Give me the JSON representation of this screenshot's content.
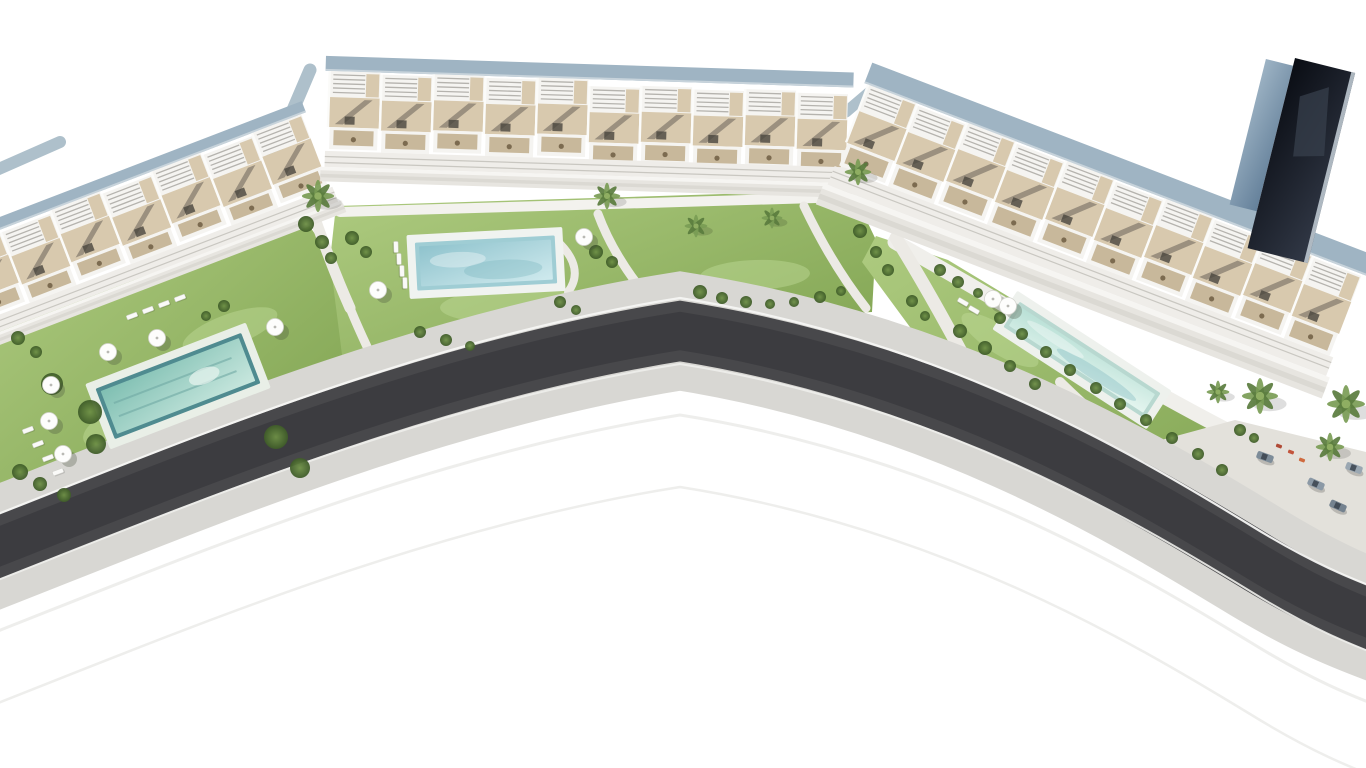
{
  "scene": {
    "width": 1366,
    "height": 768,
    "background": "#ffffff"
  },
  "palette": {
    "grass1": "#aecb80",
    "grass2": "#7ca04d",
    "grass_light": "#c2db9a",
    "bush_core": "#6e9046",
    "bush_edge": "#3f5c29",
    "palm1": "#5a7c3e",
    "palm2": "#7a9c55",
    "palm_crown": "#8fae62",
    "path": "#eceae5",
    "promenade": "#f3f2ee",
    "plaza": "#e3e1db",
    "sidewalk": "#d8d7d3",
    "asphalt": "#48484b",
    "asphalt_core": "#3a3a3d",
    "curb": "#f5f5f3",
    "curb_low": "#eeeeeb",
    "faint_arc": "#ececea",
    "white": "#f5f4f1",
    "beige": "#d8c9ae",
    "beige_dark": "#c3b191",
    "stripe": "#b5b3ae",
    "shadow": "#5e5850",
    "window": "#4a463f",
    "roof": "#9fb4c3",
    "roof_edge": "#c7d3db",
    "facade": "#efede9",
    "facade_line": "#c9c7c1",
    "walk1": "#f6f5f2",
    "walk2": "#e7e5e0",
    "walk3": "#dbd9d3",
    "wall": "#aec0cb",
    "umbrella": "#fdfdfc",
    "umbrella_rim": "#d5d5d0",
    "umbrella_shadow": "#44503a",
    "lounger": "#fafaf8",
    "lounger_rim": "#cfcfca",
    "furniture_dot": "#7c6b50",
    "tower_edge": "#c6d0d8",
    "tower_glint": "#39414f",
    "car_glass": "#39434d"
  },
  "road": {
    "centerline": "M -30 558 C 170 480, 420 372, 680 331 C 940 372, 1130 485, 1250 558 C 1310 595, 1350 612, 1400 630",
    "sidewalk_w": 118,
    "asphalt_w": 60,
    "core_w": 38,
    "curb_offset": 33,
    "faint_offsets": [
      84,
      156
    ]
  },
  "gardens": [
    {
      "name": "left-garden",
      "points": "0,318 300,212 334,262 352,398 232,470 62,506 0,516"
    },
    {
      "name": "middle-garden",
      "points": "336,206 852,190 876,240 872,312 700,322 430,380 348,402 330,260"
    },
    {
      "name": "right-garden",
      "points": "876,236 948,260 1140,376 1310,468 1348,522 1240,522 1060,440 918,338 862,262"
    }
  ],
  "grass_patches": [
    [
      140,
      420,
      60,
      22,
      -20
    ],
    [
      520,
      305,
      80,
      18,
      -2
    ],
    [
      755,
      275,
      55,
      15,
      -2
    ],
    [
      1000,
      340,
      45,
      14,
      33
    ],
    [
      230,
      330,
      50,
      16,
      -20
    ]
  ],
  "plaza": {
    "points": "1095,458 1235,420 1366,452 1366,572 1200,525"
  },
  "paths": [
    {
      "name": "left-promenade",
      "d": "M 0,322 L 300,216",
      "w": 10,
      "c": "#f3f2ee"
    },
    {
      "name": "middle-promenade",
      "d": "M 340,212 L 850,197",
      "w": 10,
      "c": "#f3f2ee"
    },
    {
      "name": "right-promenade",
      "d": "M 895,242 C 1030,318 1180,412 1312,472",
      "w": 15,
      "c": "#f0efeb"
    },
    {
      "name": "gap-path-left",
      "d": "M 308,198 C 322,240 334,272 350,308",
      "w": 11
    },
    {
      "name": "gap-path-left-lower",
      "d": "M 350,308 C 358,328 366,344 372,358",
      "w": 9
    },
    {
      "name": "middle-garden-path-1",
      "d": "M 598,214 C 612,252 636,286 664,316",
      "w": 9
    },
    {
      "name": "middle-garden-path-2",
      "d": "M 804,206 C 824,248 844,280 866,308",
      "w": 9
    },
    {
      "name": "gap-path-right",
      "d": "M 896,238 C 925,285 950,330 975,378",
      "w": 13
    },
    {
      "name": "pool-loop-path",
      "d": "M 556,240 C 576,258 580,276 568,292",
      "w": 8
    },
    {
      "name": "right-garden-path",
      "d": "M 1060,382 C 1090,412 1120,436 1150,458",
      "w": 10
    }
  ],
  "walls": [
    {
      "name": "rear-wall-left-gap",
      "d": "M 252,206 L 310,70",
      "w": 13
    },
    {
      "name": "rear-wall-far-left",
      "d": "M -8,172 L 60,142",
      "w": 12
    },
    {
      "name": "rear-wall-right-gap",
      "d": "M 846,112 L 886,78",
      "w": 11
    }
  ],
  "buildings": [
    {
      "name": "left-building",
      "x": -55,
      "y": 238,
      "angle": -21,
      "units": 7,
      "uw": 54,
      "alt": 3,
      "kink_at": 99,
      "kink_dy": 0,
      "roof_h": 12,
      "perg_h": 26,
      "terr_h": 30,
      "balc_h": 20,
      "fac_h": 16,
      "base_h": 12
    },
    {
      "name": "middle-building",
      "x": 330,
      "y": 56,
      "angle": 1.8,
      "units": 10,
      "uw": 52,
      "alt": 2,
      "kink_at": 5,
      "kink_dy": 5,
      "roof_h": 15,
      "perg_h": 26,
      "terr_h": 30,
      "balc_h": 22,
      "fac_h": 16,
      "base_h": 14
    },
    {
      "name": "right-building",
      "x": 876,
      "y": 64,
      "angle": 21,
      "units": 10,
      "uw": 53,
      "alt": 2,
      "kink_at": 99,
      "kink_dy": 0,
      "roof_h": 22,
      "perg_h": 28,
      "terr_h": 34,
      "balc_h": 24,
      "fac_h": 20,
      "base_h": 22
    }
  ],
  "tower": {
    "x": 1295,
    "y": 58,
    "angle": 14,
    "dark_w": 62,
    "dark_h": 196,
    "side_w": 28,
    "side_h": 150,
    "side_y": 8
  },
  "pools": [
    {
      "name": "left-pool",
      "x": 178,
      "y": 386,
      "angle": -21,
      "w": 156,
      "h": 54,
      "deck": "#e9efe7",
      "rim": "#4f8b90",
      "water": "waterA",
      "lanes": true
    },
    {
      "name": "middle-pool",
      "x": 486,
      "y": 263,
      "angle": -3,
      "w": 140,
      "h": 48,
      "deck": "#f0f3f0",
      "rim": "#9fcdd4",
      "water": "waterB",
      "lanes": false
    },
    {
      "name": "right-pool",
      "x": 1082,
      "y": 360,
      "angle": 33,
      "w": 168,
      "h": 30,
      "deck": "#eef1ed",
      "rim": "#b8d8d0",
      "water": "waterC",
      "lanes": false
    }
  ],
  "bushes": [
    [
      18,
      338,
      7
    ],
    [
      36,
      352,
      6
    ],
    [
      306,
      224,
      8
    ],
    [
      322,
      242,
      7
    ],
    [
      331,
      258,
      6
    ],
    [
      20,
      472,
      8
    ],
    [
      40,
      484,
      7
    ],
    [
      64,
      495,
      7
    ],
    [
      52,
      384,
      11
    ],
    [
      90,
      412,
      12
    ],
    [
      96,
      444,
      10
    ],
    [
      276,
      437,
      12
    ],
    [
      300,
      468,
      10
    ],
    [
      224,
      306,
      6
    ],
    [
      206,
      316,
      5
    ],
    [
      352,
      238,
      7
    ],
    [
      366,
      252,
      6
    ],
    [
      420,
      332,
      6
    ],
    [
      446,
      340,
      6
    ],
    [
      470,
      346,
      5
    ],
    [
      560,
      302,
      6
    ],
    [
      576,
      310,
      5
    ],
    [
      596,
      252,
      7
    ],
    [
      612,
      262,
      6
    ],
    [
      700,
      292,
      7
    ],
    [
      722,
      298,
      6
    ],
    [
      746,
      302,
      6
    ],
    [
      770,
      304,
      5
    ],
    [
      794,
      302,
      5
    ],
    [
      820,
      297,
      6
    ],
    [
      841,
      291,
      5
    ],
    [
      860,
      231,
      7
    ],
    [
      876,
      252,
      6
    ],
    [
      888,
      270,
      6
    ],
    [
      940,
      270,
      6
    ],
    [
      958,
      282,
      6
    ],
    [
      978,
      293,
      5
    ],
    [
      1000,
      318,
      6
    ],
    [
      1022,
      334,
      6
    ],
    [
      1046,
      352,
      6
    ],
    [
      1070,
      370,
      6
    ],
    [
      1096,
      388,
      6
    ],
    [
      1120,
      404,
      6
    ],
    [
      1146,
      420,
      6
    ],
    [
      1172,
      438,
      6
    ],
    [
      1198,
      454,
      6
    ],
    [
      960,
      331,
      7
    ],
    [
      985,
      348,
      7
    ],
    [
      1010,
      366,
      6
    ],
    [
      1035,
      384,
      6
    ],
    [
      912,
      301,
      6
    ],
    [
      925,
      316,
      5
    ],
    [
      1240,
      430,
      6
    ],
    [
      1254,
      438,
      5
    ],
    [
      1222,
      470,
      6
    ]
  ],
  "palms": [
    [
      318,
      196,
      17
    ],
    [
      607,
      196,
      14
    ],
    [
      696,
      226,
      12
    ],
    [
      772,
      218,
      11
    ],
    [
      858,
      172,
      14
    ],
    [
      1218,
      392,
      12
    ],
    [
      1260,
      396,
      19
    ],
    [
      1346,
      404,
      20
    ],
    [
      1330,
      447,
      15
    ]
  ],
  "umbrellas": [
    [
      275,
      327
    ],
    [
      157,
      338
    ],
    [
      108,
      352
    ],
    [
      51,
      385
    ],
    [
      49,
      421
    ],
    [
      63,
      454
    ],
    [
      378,
      290
    ],
    [
      584,
      237
    ],
    [
      993,
      299
    ],
    [
      1008,
      306
    ]
  ],
  "loungers": [
    [
      28,
      430,
      -21
    ],
    [
      38,
      444,
      -21
    ],
    [
      48,
      458,
      -21
    ],
    [
      58,
      472,
      -21
    ],
    [
      132,
      316,
      -21
    ],
    [
      148,
      310,
      -21
    ],
    [
      164,
      304,
      -21
    ],
    [
      180,
      298,
      -21
    ],
    [
      396,
      247,
      88
    ],
    [
      399,
      259,
      88
    ],
    [
      402,
      271,
      88
    ],
    [
      405,
      283,
      88
    ],
    [
      963,
      302,
      30
    ],
    [
      974,
      310,
      30
    ]
  ],
  "cars": [
    [
      1265,
      457,
      20,
      "#7d8c99"
    ],
    [
      1316,
      484,
      24,
      "#8b99a6"
    ],
    [
      1338,
      506,
      24,
      "#74828f"
    ],
    [
      1354,
      468,
      20,
      "#9aa7b2"
    ]
  ],
  "car_accents": [
    [
      1291,
      452,
      "#c2553d"
    ],
    [
      1302,
      460,
      "#cf6a3e"
    ],
    [
      1279,
      446,
      "#b04a36"
    ]
  ]
}
